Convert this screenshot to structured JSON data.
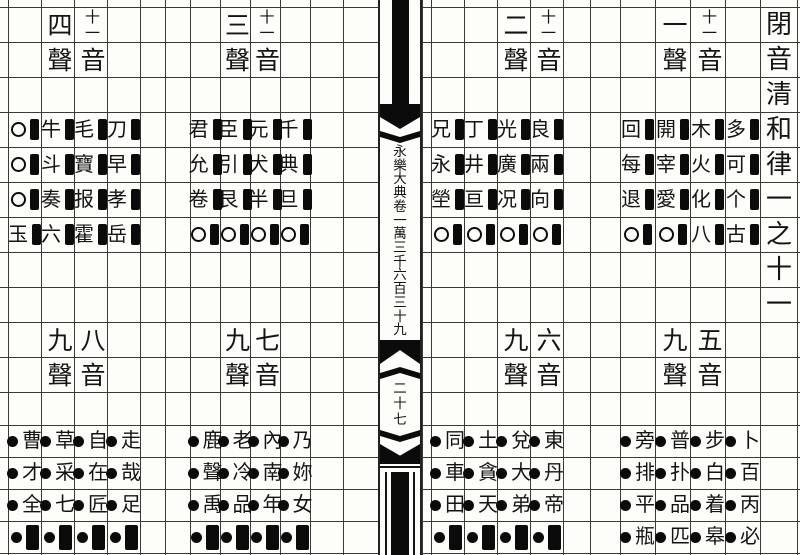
{
  "document_title": "閉音清和律一之十一",
  "title_column_chars": [
    "閉",
    "音",
    "清",
    "和",
    "律",
    "一",
    "之",
    "十",
    "一"
  ],
  "spine": {
    "volume_text": "永樂大典卷一萬三千六百三十九",
    "volume_chars": [
      "永",
      "樂",
      "大",
      "典",
      "卷",
      "一",
      "萬",
      "三",
      "千",
      "六",
      "百",
      "三",
      "十",
      "九"
    ],
    "page_number": "二十七",
    "page_number_chars": [
      "二",
      "十",
      "七"
    ]
  },
  "sections": [
    {
      "id": "sheng1-yin11",
      "position": "top-right",
      "tone_label": "一聲",
      "tone_chars": [
        "一",
        "聲"
      ],
      "category_label": "十一音",
      "category_chars": [
        "十一",
        "音"
      ],
      "rows": [
        [
          "回",
          "開",
          "木",
          "多"
        ],
        [
          "每",
          "宰",
          "火",
          "可"
        ],
        [
          "退",
          "愛",
          "化",
          "个"
        ],
        [
          "○",
          "○",
          "八",
          "古"
        ]
      ]
    },
    {
      "id": "sheng2-yin11",
      "position": "top-mid-right",
      "tone_label": "二聲",
      "tone_chars": [
        "二",
        "聲"
      ],
      "category_label": "十一音",
      "category_chars": [
        "十一",
        "音"
      ],
      "rows": [
        [
          "兄",
          "丁",
          "光",
          "良"
        ],
        [
          "永",
          "井",
          "廣",
          "兩"
        ],
        [
          "塋",
          "亘",
          "况",
          "向"
        ],
        [
          "○",
          "○",
          "○",
          "○"
        ]
      ]
    },
    {
      "id": "sheng3-yin11",
      "position": "top-mid-left",
      "tone_label": "三聲",
      "tone_chars": [
        "三",
        "聲"
      ],
      "category_label": "十一音",
      "category_chars": [
        "十一",
        "音"
      ],
      "rows": [
        [
          "君",
          "臣",
          "元",
          "千"
        ],
        [
          "允",
          "引",
          "犬",
          "典"
        ],
        [
          "卷",
          "艮",
          "半",
          "旦"
        ],
        [
          "○",
          "○",
          "○",
          "○"
        ]
      ]
    },
    {
      "id": "sheng4-yin11",
      "position": "top-left",
      "tone_label": "四聲",
      "tone_chars": [
        "四",
        "聲"
      ],
      "category_label": "十一音",
      "category_chars": [
        "十一",
        "音"
      ],
      "rows": [
        [
          "○",
          "牛",
          "毛",
          "刀"
        ],
        [
          "○",
          "斗",
          "寶",
          "早"
        ],
        [
          "○",
          "奏",
          "报",
          "孝"
        ],
        [
          "玉",
          "六",
          "霍",
          "岳"
        ]
      ]
    },
    {
      "id": "yin5-sheng9",
      "position": "bottom-right",
      "tone_label": "九聲",
      "tone_chars": [
        "九",
        "聲"
      ],
      "category_label": "五音",
      "category_chars": [
        "五",
        "音"
      ],
      "rows": [
        [
          "旁",
          "普",
          "步",
          "卜"
        ],
        [
          "排",
          "扑",
          "白",
          "百"
        ],
        [
          "平",
          "品",
          "着",
          "丙"
        ],
        [
          "瓶",
          "匹",
          "皋",
          "必"
        ]
      ]
    },
    {
      "id": "yin6-sheng9",
      "position": "bottom-mid-right",
      "tone_label": "九聲",
      "tone_chars": [
        "九",
        "聲"
      ],
      "category_label": "六音",
      "category_chars": [
        "六",
        "音"
      ],
      "rows": [
        [
          "同",
          "土",
          "兌",
          "東"
        ],
        [
          "車",
          "貪",
          "大",
          "丹"
        ],
        [
          "田",
          "天",
          "弟",
          "帝"
        ],
        [
          "■",
          "■",
          "■",
          "■"
        ]
      ]
    },
    {
      "id": "yin7-sheng9",
      "position": "bottom-mid-left",
      "tone_label": "九聲",
      "tone_chars": [
        "九",
        "聲"
      ],
      "category_label": "七音",
      "category_chars": [
        "七",
        "音"
      ],
      "rows": [
        [
          "鹿",
          "老",
          "內",
          "乃"
        ],
        [
          "聲",
          "冷",
          "南",
          "妳"
        ],
        [
          "禹",
          "品",
          "年",
          "女"
        ],
        [
          "■",
          "■",
          "■",
          "■"
        ]
      ]
    },
    {
      "id": "yin8-sheng9",
      "position": "bottom-left",
      "tone_label": "九聲",
      "tone_chars": [
        "九",
        "聲"
      ],
      "category_label": "八音",
      "category_chars": [
        "八",
        "音"
      ],
      "rows": [
        [
          "曹",
          "草",
          "自",
          "走"
        ],
        [
          "才",
          "采",
          "在",
          "哉"
        ],
        [
          "全",
          "七",
          "匠",
          "足"
        ],
        [
          "■",
          "■",
          "■",
          "■"
        ]
      ]
    }
  ]
}
